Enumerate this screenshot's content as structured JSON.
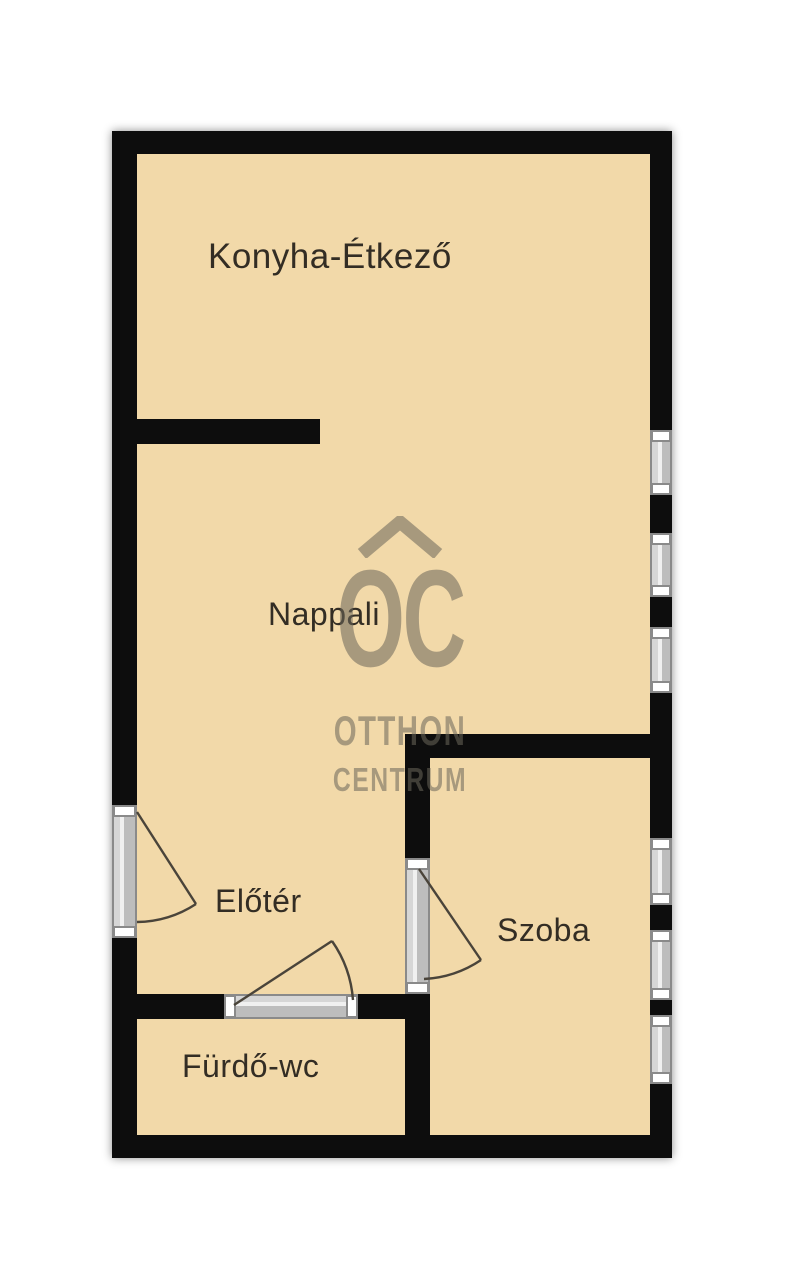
{
  "plan": {
    "type": "floor-plan",
    "rooms": [
      {
        "id": "konyha-etkezo",
        "label": "Konyha-Étkező"
      },
      {
        "id": "nappali",
        "label": "Nappali"
      },
      {
        "id": "eloter",
        "label": "Előtér"
      },
      {
        "id": "szoba",
        "label": "Szoba"
      },
      {
        "id": "furdo-wc",
        "label": "Fürdő-wc"
      }
    ],
    "features": {
      "windows_right_wall": 6,
      "doors": [
        "entry-door-left-wall",
        "eloter-furdo-door",
        "eloter-szoba-door"
      ]
    }
  },
  "watermark": {
    "logo": "OC",
    "line1": "OTTHON",
    "line2": "CENTRUM"
  },
  "colors": {
    "floor": "#f2d9a9",
    "wall": "#0d0d0d",
    "window_body": "#c7c7c7",
    "window_edge": "#8a8a8a",
    "window_cap": "#ffffff",
    "door_line": "#4a443a",
    "label": "#332d24",
    "watermark": "#6b665a",
    "page": "#ffffff"
  }
}
